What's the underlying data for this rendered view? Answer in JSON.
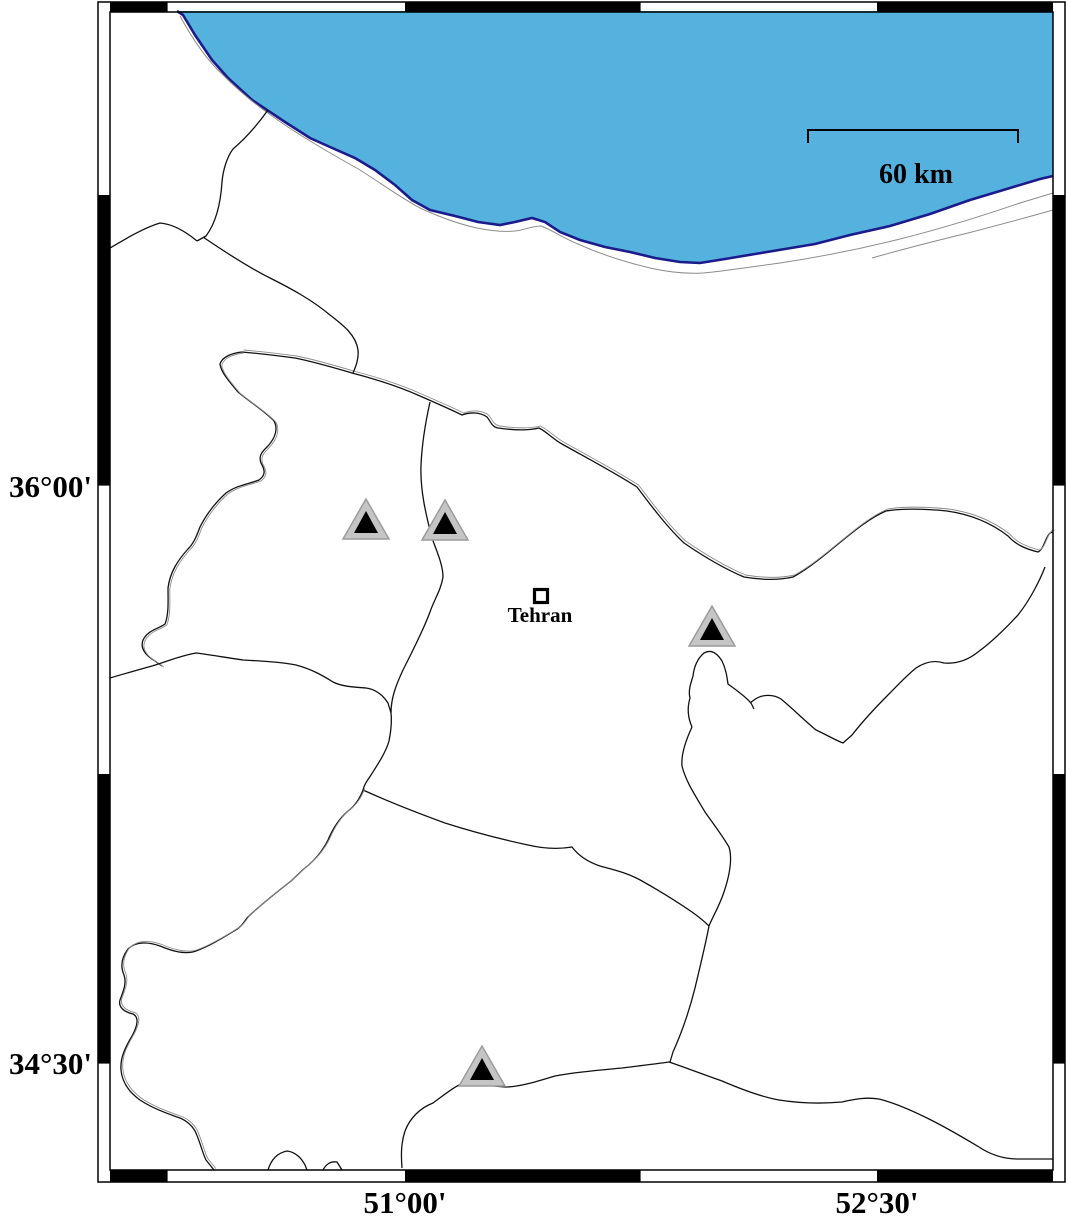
{
  "map": {
    "description": "Coastal reference map of the Tehran region with seismic station markers",
    "city": {
      "label": "Tehran",
      "marker_x": 541,
      "marker_y": 596,
      "label_x": 540,
      "label_y": 622,
      "approx_lon": 51.43,
      "approx_lat": 35.71
    },
    "scale_bar": {
      "label": "60 km",
      "x1": 808,
      "x2": 1018,
      "y": 130,
      "tick_len": 13,
      "label_x": 916,
      "label_y": 183
    },
    "latitude_ticks": [
      {
        "label": "36°00'",
        "y": 486
      },
      {
        "label": "34°30'",
        "y": 1063
      }
    ],
    "longitude_ticks": [
      {
        "label": "51°00'",
        "x": 405
      },
      {
        "label": "52°30'",
        "x": 877
      }
    ],
    "stations": [
      {
        "x": 366,
        "y": 520,
        "approx_lon": 50.88,
        "approx_lat": 35.91
      },
      {
        "x": 445,
        "y": 521,
        "approx_lon": 51.13,
        "approx_lat": 35.91
      },
      {
        "x": 712,
        "y": 627,
        "approx_lon": 51.97,
        "approx_lat": 35.63
      },
      {
        "x": 482,
        "y": 1067,
        "approx_lon": 51.24,
        "approx_lat": 34.49
      }
    ],
    "colors": {
      "water": "#55b1dd",
      "coast_stroke": "#1b1b8a",
      "border_line": "#111111",
      "secondary_line": "#8c8c8c",
      "station_fill": "#c5c5c5",
      "station_edge": "#9c9c9c",
      "station_inner": "#000000",
      "frame_black": "#000000"
    }
  }
}
